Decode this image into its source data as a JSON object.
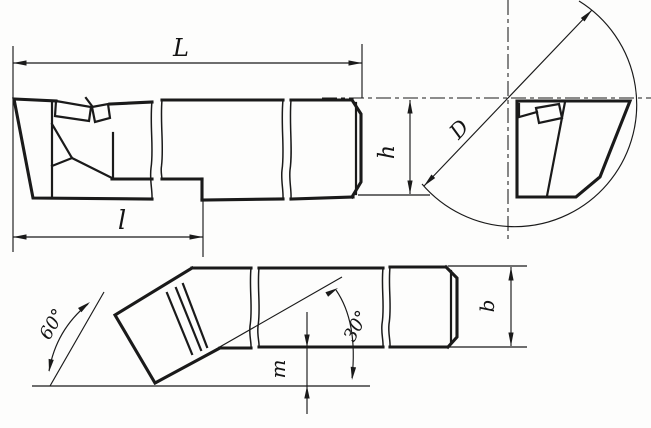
{
  "drawing": {
    "labels": {
      "overall_length": "L",
      "working_length": "l",
      "bore_diameter": "D",
      "shank_height": "h",
      "tip_offset": "m",
      "shank_width": "b",
      "head_angle": "60°",
      "edge_angle": "30°"
    },
    "line_color": "#1a1a1a",
    "background_color": "#fdfdfc"
  }
}
